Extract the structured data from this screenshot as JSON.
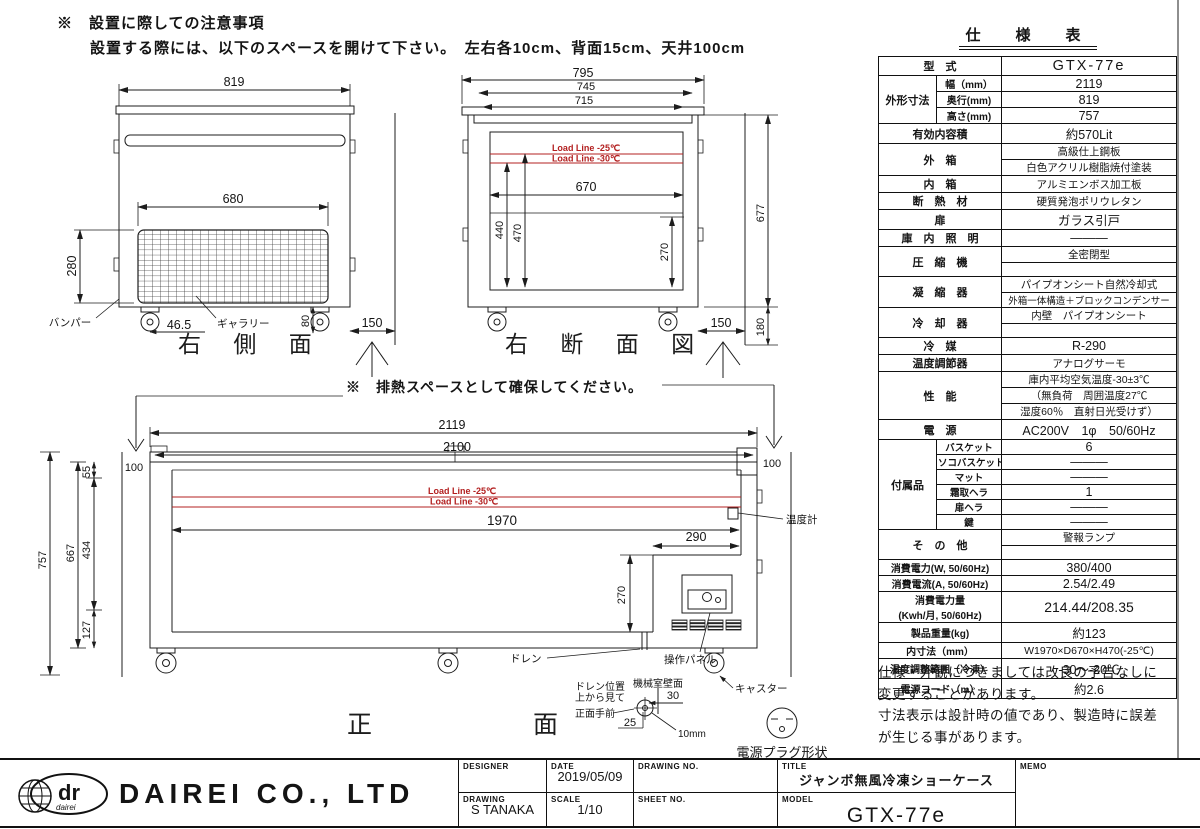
{
  "notes": {
    "caution_title": "※　設置に際しての注意事項",
    "caution_body": "設置する際には、以下のスペースを開けて下さい。　左右各10cm、背面15cm、天井100cm",
    "heat_space": "※　排熱スペースとして確保してください。"
  },
  "side_view": {
    "title": "右 側 面",
    "w819": "819",
    "w680": "680",
    "h280": "280",
    "foot": "46.5",
    "h80": "80",
    "clear": "150",
    "bumper": "バンパー",
    "gallery": "ギャラリー"
  },
  "section_view": {
    "title": "右 断 面 図",
    "w795": "795",
    "w745": "745",
    "w715": "715",
    "w670": "670",
    "v440": "440",
    "v470": "470",
    "v270": "270",
    "v677": "677",
    "v180": "180",
    "clear": "150",
    "load25": "Load Line -25℃",
    "load30": "Load Line -30℃"
  },
  "front_view": {
    "title": "正　面",
    "w2119": "2119",
    "w2100": "2100",
    "c100_left": "100",
    "c100_right": "100",
    "w1970": "1970",
    "w290": "290",
    "v270": "270",
    "v757": "757",
    "v667": "667",
    "v55": "55",
    "v434": "434",
    "v127": "127",
    "d30": "30",
    "d25": "25",
    "d10": "10mm",
    "load25": "Load Line -25℃",
    "load30": "Load Line -30℃",
    "thermometer": "温度計",
    "drain": "ドレン",
    "panel": "操作パネル",
    "caster": "キャスター",
    "drain_pos1": "ドレン位置",
    "drain_pos2": "上から見て",
    "front_near": "正面手前",
    "machine_wall": "機械室壁面",
    "plug": "電源プラグ形状"
  },
  "spec": {
    "title": "仕　様　表",
    "model_label": "型　式",
    "model_value": "GTX-77e",
    "dims_label": "外形寸法",
    "width_label": "幅（mm）",
    "width_value": "2119",
    "depth_label": "奥行(mm)",
    "depth_value": "819",
    "height_label": "高さ(mm)",
    "height_value": "757",
    "capacity_label": "有効内容積",
    "capacity_value": "約570Lit",
    "exterior_label": "外　箱",
    "exterior_value1": "高級仕上鋼板",
    "exterior_value2": "白色アクリル樹脂焼付塗装",
    "interior_label": "内　箱",
    "interior_value": "アルミエンボス加工板",
    "insulation_label": "断　熱　材",
    "insulation_value": "硬質発泡ポリウレタン",
    "door_label": "扉",
    "door_value": "ガラス引戸",
    "light_label": "庫　内　照　明",
    "light_value": "———",
    "compressor_label": "圧　縮　機",
    "compressor_value": "全密閉型",
    "condenser_label": "凝　縮　器",
    "condenser_value1": "パイプオンシート自然冷却式",
    "condenser_value2": "外箱一体構造＋ブロックコンデンサー",
    "cooler_label": "冷　却　器",
    "cooler_value": "内壁　パイプオンシート",
    "refrigerant_label": "冷　媒",
    "refrigerant_value": "R-290",
    "thermostat_label": "温度調節器",
    "thermostat_value": "アナログサーモ",
    "performance_label": "性　能",
    "performance_value1": "庫内平均空気温度-30±3℃",
    "performance_value2": "（無負荷　周囲温度27℃",
    "performance_value3": "湿度60％　直射日光受けず）",
    "power_label": "電　源",
    "power_value": "AC200V　1φ　50/60Hz",
    "accessories_label": "付属品",
    "basket_label": "バスケット",
    "basket_value": "6",
    "bottom_basket_label": "ソコバスケット",
    "bottom_basket_value": "———",
    "mat_label": "マット",
    "mat_value": "———",
    "frost_label": "霜取ヘラ",
    "frost_value": "1",
    "door_spatula_label": "扉ヘラ",
    "door_spatula_value": "———",
    "key_label": "鍵",
    "key_value": "———",
    "other_label": "そ　の　他",
    "other_value": "警報ランプ",
    "power_w_label": "消費電力(W, 50/60Hz)",
    "power_w_value": "380/400",
    "current_label": "消費電流(A, 50/60Hz)",
    "current_value": "2.54/2.49",
    "energy_label1": "消費電力量",
    "energy_label2": "(Kwh/月, 50/60Hz)",
    "energy_value": "214.44/208.35",
    "weight_label": "製品重量(kg)",
    "weight_value": "約123",
    "inner_label": "内寸法（mm）",
    "inner_value": "W1970×D670×H470(-25℃)",
    "range_label": "温度調整範囲（冷凍）",
    "range_value": "-30～-20℃",
    "cord_label": "電源コード（m）",
    "cord_value": "約2.6"
  },
  "disclaimer": {
    "line1": "仕様・外観につきましては改良の予告なしに",
    "line2": "変更することがあります。",
    "line3": "寸法表示は設計時の値であり、製造時に誤差",
    "line4": "が生じる事があります。"
  },
  "title_block": {
    "company": "DAIREI CO., LTD",
    "logo_main": "dr",
    "logo_sub": "dairei",
    "designer_label": "DESIGNER",
    "date_label": "DATE",
    "date_value": "2019/05/09",
    "drawing_no_label": "DRAWING NO.",
    "title_label": "TITLE",
    "title_value": "ジャンボ無風冷凍ショーケース",
    "memo_label": "MEMO",
    "drawing_label": "DRAWING",
    "drawing_value": "S TANAKA",
    "scale_label": "SCALE",
    "scale_value": "1/10",
    "sheet_no_label": "SHEET NO.",
    "model_label": "MODEL",
    "model_value": "GTX-77e"
  }
}
